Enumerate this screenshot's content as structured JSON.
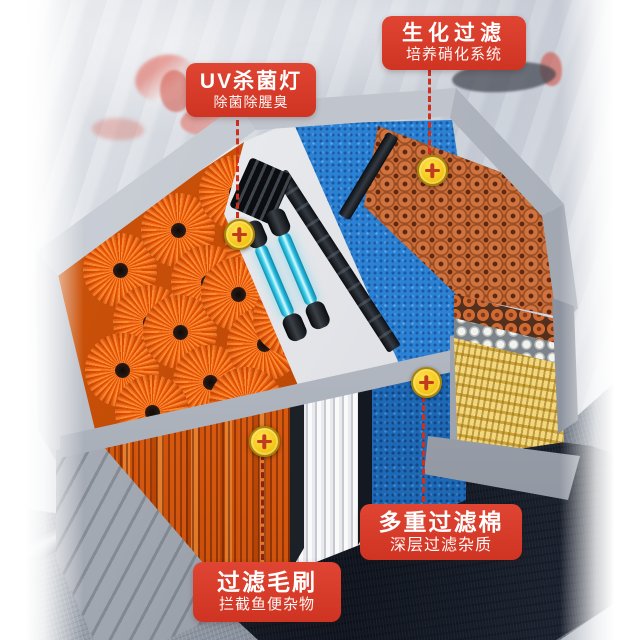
{
  "palette": {
    "callout_red": "#d83a2a",
    "dashed_line_red": "#cf2f1d",
    "marker_yellow": "#f3c313",
    "marker_cross_red": "#c23a20",
    "brush_orange": "#f06a14",
    "uv_lamp_cyan": "#3fd0ec",
    "sponge_blue": "#2b82d4",
    "bio_ring_orange": "#cf7340",
    "bio_stick_yellow": "#e9c95f",
    "box_gray": "#aab0ba",
    "platform_dark": "#161b26",
    "valve_red": "#d32817"
  },
  "markers": {
    "icon": "plus-target-icon",
    "count": 4
  },
  "callouts": {
    "uv_lamp": {
      "title": "UV杀菌灯",
      "subtitle": "除菌除腥臭"
    },
    "bio_filter": {
      "title": "生化过滤",
      "subtitle": "培养硝化系统"
    },
    "filter_cotton": {
      "title": "多重过滤棉",
      "subtitle": "深层过滤杂质"
    },
    "filter_brush": {
      "title": "过滤毛刷",
      "subtitle": "拦截鱼便杂物"
    }
  }
}
